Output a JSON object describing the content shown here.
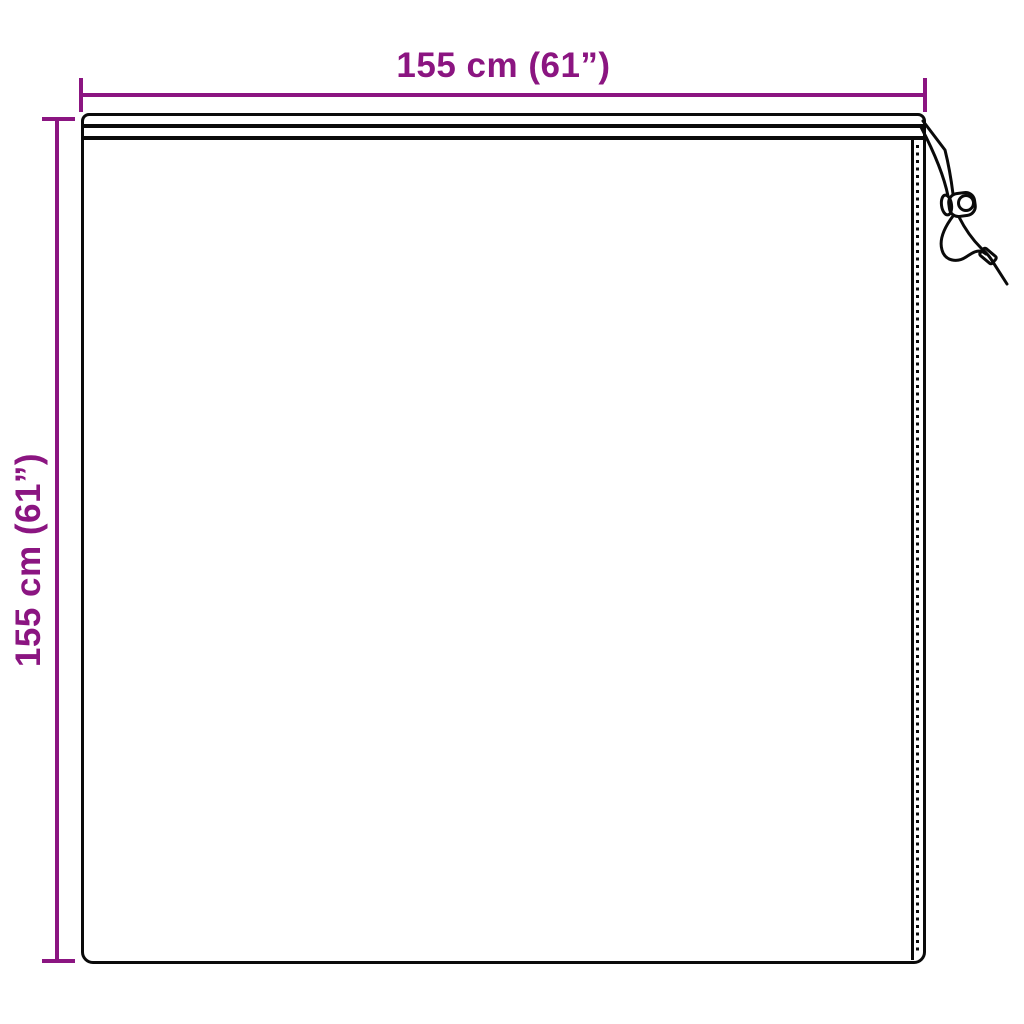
{
  "colors": {
    "dimension": "#8B1581",
    "outline": "#0A0A0A",
    "background": "#FFFFFF"
  },
  "dimensions": {
    "width_label": "155 cm (61”)",
    "height_label": "155 cm (61”)"
  },
  "product": {
    "shape": "square-cover",
    "parts": [
      "hem-channel",
      "right-hem-channel",
      "stitch-line",
      "drawstring-cord",
      "cord-lock-toggle",
      "cord-aglet"
    ]
  }
}
